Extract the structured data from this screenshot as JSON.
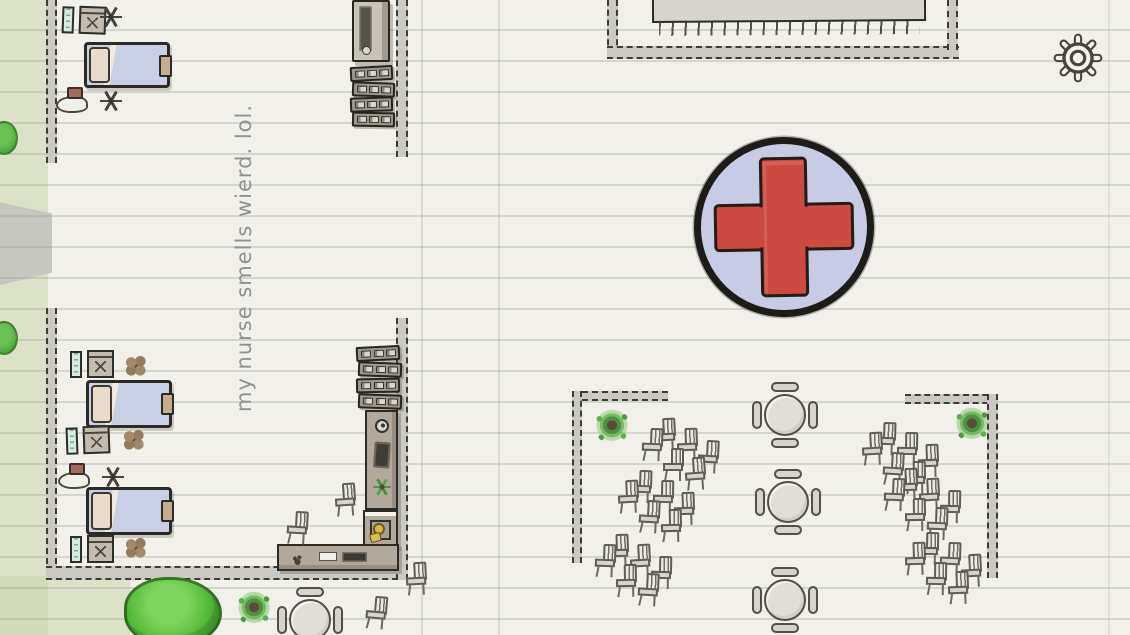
{
  "annotation": {
    "note_text": "my nurse smells wierd. lol."
  },
  "hud": {
    "settings_icon": "gear-icon"
  },
  "sign": {
    "symbol": "medical-cross"
  },
  "colors": {
    "paper": "#f1f0ea",
    "paper_line": "rgba(145,160,140,0.32)",
    "outside": "rgba(203,213,174,0.55)",
    "path": "#c7c7c2",
    "wall": "#cbc9c3",
    "wall_edge": "#3c3b34",
    "ink": "#2b2a24",
    "sign_fill": "#c7cbe3",
    "cross_red": "#cc4a42",
    "blanket": "#c9cfe5",
    "pillow": "#e9dccd",
    "counter": "#b2a99c",
    "furniture_light": "#d9d6ce",
    "plant_green": "#4e9a43",
    "tree_green": "#58bb3e",
    "flower_brown": "#937c5e",
    "screen_teal": "#d6ece3",
    "accent_yellow": "#dcb93f",
    "note_grey": "#8d938f"
  },
  "map": {
    "walls": [
      {
        "dir": "v",
        "x": 46,
        "y": 0,
        "w": 11,
        "h": 163
      },
      {
        "dir": "v",
        "x": 46,
        "y": 308,
        "w": 11,
        "h": 266
      },
      {
        "dir": "h",
        "x": 46,
        "y": 566,
        "w": 362,
        "h": 14
      },
      {
        "dir": "v",
        "x": 396,
        "y": 0,
        "w": 12,
        "h": 157
      },
      {
        "dir": "v",
        "x": 396,
        "y": 318,
        "w": 12,
        "h": 262
      },
      {
        "dir": "v",
        "x": 607,
        "y": 0,
        "w": 11,
        "h": 55
      },
      {
        "dir": "h",
        "x": 607,
        "y": 46,
        "w": 352,
        "h": 13
      },
      {
        "dir": "v",
        "x": 947,
        "y": 0,
        "w": 11,
        "h": 50
      },
      {
        "dir": "h",
        "x": 572,
        "y": 391,
        "w": 96,
        "h": 10
      },
      {
        "dir": "v",
        "x": 572,
        "y": 391,
        "w": 10,
        "h": 172
      },
      {
        "dir": "h",
        "x": 905,
        "y": 394,
        "w": 93,
        "h": 10
      },
      {
        "dir": "v",
        "x": 987,
        "y": 394,
        "w": 11,
        "h": 184
      }
    ],
    "furniture": [
      {
        "type": "vitals",
        "name": "vitals-monitor",
        "x": 62,
        "y": 6,
        "w": 46,
        "h": 30,
        "rot": 2,
        "i": true
      },
      {
        "type": "ivpole",
        "name": "iv-stand",
        "x": 100,
        "y": 6,
        "w": 24,
        "h": 26,
        "i": true
      },
      {
        "type": "bed",
        "name": "hospital-bed",
        "x": 84,
        "y": 42,
        "w": 86,
        "h": 46,
        "i": true
      },
      {
        "type": "ivkit",
        "name": "iv-pump",
        "x": 56,
        "y": 86,
        "w": 66,
        "h": 30,
        "i": true
      },
      {
        "type": "cabinet",
        "name": "supply-cabinet",
        "x": 352,
        "y": 0,
        "w": 38,
        "h": 62,
        "i": true
      },
      {
        "type": "lockers",
        "name": "locker-shelf",
        "x": 350,
        "y": 66,
        "w": 43,
        "h": 15,
        "rot": -3,
        "i": true
      },
      {
        "type": "lockers",
        "name": "locker-shelf",
        "x": 352,
        "y": 82,
        "w": 43,
        "h": 15,
        "rot": 2,
        "i": true
      },
      {
        "type": "lockers",
        "name": "locker-shelf",
        "x": 350,
        "y": 97,
        "w": 43,
        "h": 15,
        "rot": -2,
        "i": true
      },
      {
        "type": "lockers",
        "name": "locker-shelf",
        "x": 352,
        "y": 112,
        "w": 43,
        "h": 15,
        "rot": 1,
        "i": true
      },
      {
        "type": "vitals",
        "name": "vitals-monitor",
        "x": 70,
        "y": 350,
        "w": 46,
        "h": 30,
        "i": true
      },
      {
        "type": "flower",
        "name": "dried-flower",
        "x": 124,
        "y": 354,
        "w": 24,
        "h": 24
      },
      {
        "type": "bed",
        "name": "hospital-bed",
        "x": 86,
        "y": 380,
        "w": 86,
        "h": 48,
        "i": true
      },
      {
        "type": "vitals",
        "name": "vitals-monitor",
        "x": 66,
        "y": 426,
        "w": 46,
        "h": 30,
        "rot": -2,
        "i": true
      },
      {
        "type": "flower",
        "name": "dried-flower",
        "x": 122,
        "y": 428,
        "w": 24,
        "h": 24
      },
      {
        "type": "ivkit",
        "name": "iv-pump",
        "x": 58,
        "y": 462,
        "w": 66,
        "h": 32,
        "i": true
      },
      {
        "type": "bed",
        "name": "hospital-bed",
        "x": 86,
        "y": 487,
        "w": 86,
        "h": 48,
        "i": true
      },
      {
        "type": "vitals",
        "name": "vitals-monitor",
        "x": 70,
        "y": 535,
        "w": 46,
        "h": 30,
        "i": true
      },
      {
        "type": "flower",
        "name": "dried-flower",
        "x": 124,
        "y": 536,
        "w": 24,
        "h": 24
      },
      {
        "type": "lockers",
        "name": "locker-shelf",
        "x": 356,
        "y": 346,
        "w": 44,
        "h": 15,
        "rot": -3,
        "i": true
      },
      {
        "type": "lockers",
        "name": "locker-shelf",
        "x": 358,
        "y": 362,
        "w": 44,
        "h": 15,
        "rot": 2,
        "i": true
      },
      {
        "type": "lockers",
        "name": "locker-shelf",
        "x": 356,
        "y": 378,
        "w": 44,
        "h": 15,
        "rot": -1,
        "i": true
      },
      {
        "type": "lockers",
        "name": "locker-shelf",
        "x": 358,
        "y": 394,
        "w": 44,
        "h": 15,
        "rot": 2,
        "i": true
      },
      {
        "type": "counterv",
        "name": "reception-counter",
        "x": 365,
        "y": 410,
        "w": 33,
        "h": 100,
        "i": true
      },
      {
        "type": "counterc",
        "name": "reception-counter-corner",
        "x": 363,
        "y": 510,
        "w": 35,
        "h": 38,
        "i": true
      },
      {
        "type": "counterh",
        "name": "reception-counter-front",
        "x": 277,
        "y": 544,
        "w": 122,
        "h": 27,
        "i": true
      },
      {
        "type": "chair",
        "name": "desk-chair",
        "x": 335,
        "y": 483,
        "rot": -4,
        "i": true
      },
      {
        "type": "chair",
        "name": "desk-chair",
        "x": 287,
        "y": 511,
        "rot": 3,
        "i": true
      },
      {
        "type": "chair",
        "name": "waiting-chair",
        "x": 655,
        "y": 418,
        "rot": -3,
        "i": true
      },
      {
        "type": "chair",
        "name": "waiting-chair",
        "x": 642,
        "y": 428,
        "rot": 2,
        "i": true
      },
      {
        "type": "chair",
        "name": "waiting-chair",
        "x": 677,
        "y": 428,
        "rot": -2,
        "i": true
      },
      {
        "type": "chair",
        "name": "waiting-chair",
        "x": 698,
        "y": 440,
        "rot": 3,
        "i": true
      },
      {
        "type": "chair",
        "name": "waiting-chair",
        "x": 663,
        "y": 448,
        "rot": 0,
        "i": true
      },
      {
        "type": "chair",
        "name": "waiting-chair",
        "x": 685,
        "y": 457,
        "rot": -4,
        "i": true
      },
      {
        "type": "chair",
        "name": "waiting-chair",
        "x": 631,
        "y": 470,
        "rot": 2,
        "i": true
      },
      {
        "type": "chair",
        "name": "waiting-chair",
        "x": 618,
        "y": 480,
        "rot": -3,
        "i": true
      },
      {
        "type": "chair",
        "name": "waiting-chair",
        "x": 653,
        "y": 480,
        "rot": 1,
        "i": true
      },
      {
        "type": "chair",
        "name": "waiting-chair",
        "x": 674,
        "y": 492,
        "rot": -2,
        "i": true
      },
      {
        "type": "chair",
        "name": "waiting-chair",
        "x": 639,
        "y": 500,
        "rot": 3,
        "i": true
      },
      {
        "type": "chair",
        "name": "waiting-chair",
        "x": 661,
        "y": 509,
        "rot": -1,
        "i": true
      },
      {
        "type": "chair",
        "name": "waiting-chair",
        "x": 608,
        "y": 534,
        "rot": -2,
        "i": true
      },
      {
        "type": "chair",
        "name": "waiting-chair",
        "x": 595,
        "y": 544,
        "rot": 2,
        "i": true
      },
      {
        "type": "chair",
        "name": "waiting-chair",
        "x": 630,
        "y": 544,
        "rot": -3,
        "i": true
      },
      {
        "type": "chair",
        "name": "waiting-chair",
        "x": 651,
        "y": 556,
        "rot": 1,
        "i": true
      },
      {
        "type": "chair",
        "name": "waiting-chair",
        "x": 616,
        "y": 564,
        "rot": -1,
        "i": true
      },
      {
        "type": "chair",
        "name": "waiting-chair",
        "x": 638,
        "y": 573,
        "rot": 3,
        "i": true
      },
      {
        "type": "chair",
        "name": "waiting-chair",
        "x": 875,
        "y": 422,
        "rot": 2,
        "i": true
      },
      {
        "type": "chair",
        "name": "waiting-chair",
        "x": 862,
        "y": 432,
        "rot": -3,
        "i": true
      },
      {
        "type": "chair",
        "name": "waiting-chair",
        "x": 897,
        "y": 432,
        "rot": 1,
        "i": true
      },
      {
        "type": "chair",
        "name": "waiting-chair",
        "x": 918,
        "y": 444,
        "rot": -2,
        "i": true
      },
      {
        "type": "chair",
        "name": "waiting-chair",
        "x": 883,
        "y": 452,
        "rot": 3,
        "i": true
      },
      {
        "type": "chair",
        "name": "waiting-chair",
        "x": 905,
        "y": 461,
        "rot": -1,
        "i": true
      },
      {
        "type": "chair",
        "name": "waiting-chair",
        "x": 897,
        "y": 468,
        "rot": -2,
        "i": true
      },
      {
        "type": "chair",
        "name": "waiting-chair",
        "x": 884,
        "y": 478,
        "rot": 2,
        "i": true
      },
      {
        "type": "chair",
        "name": "waiting-chair",
        "x": 919,
        "y": 478,
        "rot": -3,
        "i": true
      },
      {
        "type": "chair",
        "name": "waiting-chair",
        "x": 940,
        "y": 490,
        "rot": 1,
        "i": true
      },
      {
        "type": "chair",
        "name": "waiting-chair",
        "x": 905,
        "y": 498,
        "rot": -1,
        "i": true
      },
      {
        "type": "chair",
        "name": "waiting-chair",
        "x": 927,
        "y": 507,
        "rot": 2,
        "i": true
      },
      {
        "type": "chair",
        "name": "waiting-chair",
        "x": 918,
        "y": 532,
        "rot": 1,
        "i": true
      },
      {
        "type": "chair",
        "name": "waiting-chair",
        "x": 905,
        "y": 542,
        "rot": -2,
        "i": true
      },
      {
        "type": "chair",
        "name": "waiting-chair",
        "x": 940,
        "y": 542,
        "rot": 2,
        "i": true
      },
      {
        "type": "chair",
        "name": "waiting-chair",
        "x": 961,
        "y": 554,
        "rot": -3,
        "i": true
      },
      {
        "type": "chair",
        "name": "waiting-chair",
        "x": 926,
        "y": 562,
        "rot": 1,
        "i": true
      },
      {
        "type": "chair",
        "name": "waiting-chair",
        "x": 948,
        "y": 571,
        "rot": -2,
        "i": true
      },
      {
        "type": "chair",
        "name": "chair",
        "x": 366,
        "y": 596,
        "rot": 5,
        "i": true
      },
      {
        "type": "chair",
        "name": "chair",
        "x": 406,
        "y": 562,
        "rot": -3,
        "i": true
      },
      {
        "type": "rtable",
        "name": "round-table",
        "x": 753,
        "y": 383,
        "w": 64,
        "h": 64,
        "i": true
      },
      {
        "type": "rtable",
        "name": "round-table",
        "x": 756,
        "y": 470,
        "w": 64,
        "h": 64,
        "i": true
      },
      {
        "type": "rtable",
        "name": "round-table",
        "x": 753,
        "y": 568,
        "w": 64,
        "h": 64,
        "i": true
      },
      {
        "type": "rtable",
        "name": "round-table",
        "x": 278,
        "y": 588,
        "w": 64,
        "h": 64,
        "i": true
      },
      {
        "type": "plant",
        "name": "potted-plant",
        "x": 594,
        "y": 408,
        "w": 36,
        "h": 36
      },
      {
        "type": "plant",
        "name": "potted-plant",
        "x": 954,
        "y": 406,
        "w": 36,
        "h": 36
      },
      {
        "type": "plant",
        "name": "potted-plant",
        "x": 236,
        "y": 590,
        "w": 36,
        "h": 36
      },
      {
        "type": "tree",
        "name": "tree",
        "x": 124,
        "y": 577,
        "w": 98,
        "h": 70
      },
      {
        "type": "bush",
        "name": "bush",
        "x": -10,
        "y": 121,
        "w": 28,
        "h": 34
      },
      {
        "type": "bush",
        "name": "bush",
        "x": -10,
        "y": 321,
        "w": 28,
        "h": 34
      },
      {
        "type": "rug",
        "name": "fringed-rug",
        "x": 652,
        "y": -8,
        "w": 274,
        "h": 30
      }
    ]
  }
}
